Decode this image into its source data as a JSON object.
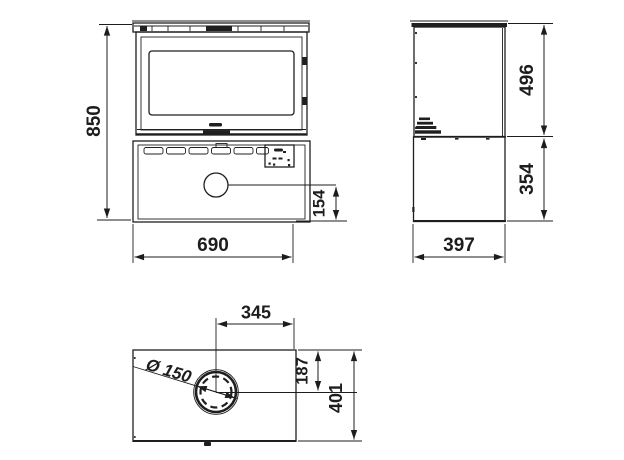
{
  "dimensions": {
    "front_height": "850",
    "front_width": "690",
    "outlet_center_height": "154",
    "side_upper_height": "496",
    "side_lower_height": "354",
    "side_depth": "397",
    "flue_offset_horizontal": "345",
    "flue_offset_depth": "187",
    "top_depth": "401",
    "flue_diameter": "Ø 150"
  },
  "colors": {
    "line": "#1f1f1f",
    "dimension": "#1d1d1d",
    "background": "#ffffff"
  }
}
